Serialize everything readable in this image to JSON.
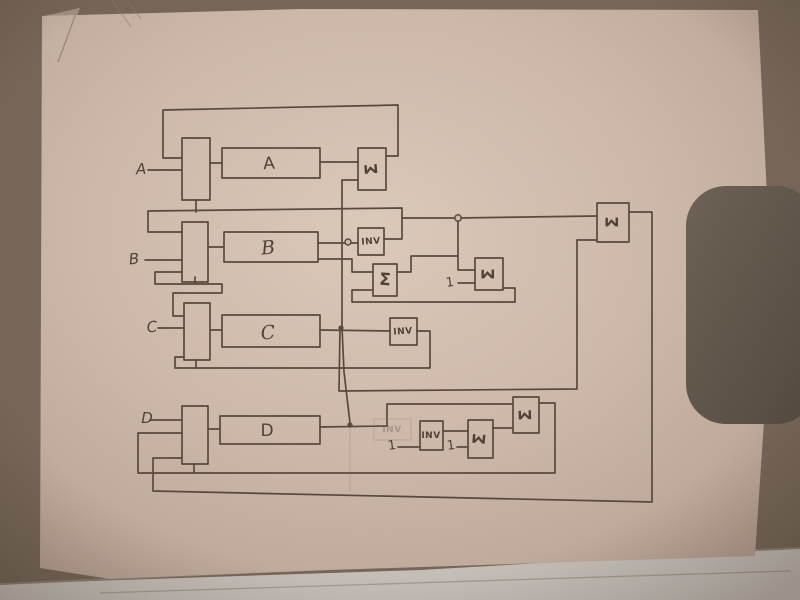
{
  "scene": {
    "description": "Photograph of a hand-drawn pencil block diagram on a sheet of paper",
    "colors": {
      "pencil": "#57483f",
      "paper": "#d2beb0",
      "background": "#6f6054",
      "dark_object": "#5e5549",
      "lower_sheet": "#cbc5bf"
    }
  },
  "labels": {
    "input_a": "A",
    "input_b": "B",
    "input_c": "C",
    "input_d": "D",
    "block_a": "A",
    "block_b": "B",
    "block_c": "C",
    "block_d": "D",
    "inv_b": "INV",
    "inv_c": "INV",
    "inv_d": "INV",
    "inv_ghost": "INV",
    "sigma_a": "Σ",
    "sigma_b1": "Σ",
    "sigma_b2": "Σ",
    "sigma_right": "Σ",
    "sigma_d1": "Σ",
    "sigma_d2": "Σ",
    "const_sigma_b2": "1",
    "const_inv_d": "1",
    "const_sigma_d1": "1"
  }
}
